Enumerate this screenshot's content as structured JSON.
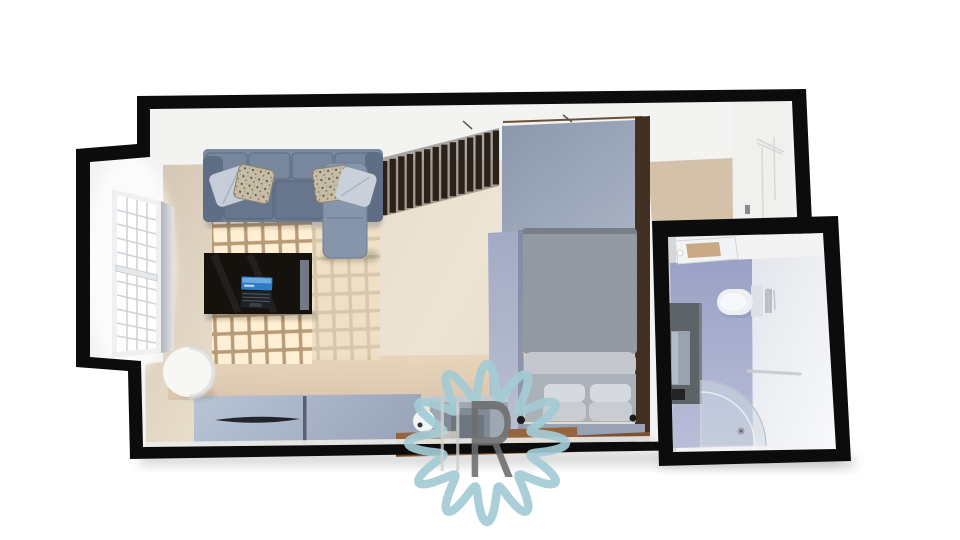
{
  "meta": {
    "title": "Studio apartment 3D floor plan render"
  },
  "watermark": {
    "letter_h": "H",
    "letter_r": "R",
    "flower_color": "#a3cbd5",
    "h_color": "#d3d0ca",
    "r_color": "#6d6d6d"
  },
  "palette": {
    "background": "#ffffff",
    "wall_black": "#0c0c0c",
    "wall_white": "#f3f3f2",
    "floor_beige": "#e8ddcb",
    "sunlight": "#ffefd4",
    "sofa_gray_blue": "#6d7c92",
    "chaise_gray": "#8695a9",
    "light_pillow": "#c6cdd8",
    "pattern_pillow": "#c7bda6",
    "slat_brown": "#2b2119",
    "wardrobe_panel": "#98a4ba",
    "bed_duvet": "#939aa3",
    "bed_pillow": "#d6d9de",
    "rug_lavender": "#a9b1c8",
    "wood_brown": "#96653f",
    "desk_black": "#15110d",
    "laptop_blue": "#2f7cc4",
    "sideboard_blue_gray": "#b2bdd1",
    "bath_floor_lavender": "#a6adcb",
    "vanity_gray": "#5d6367",
    "toilet_white": "#edeff3",
    "shower_glass": "#cfd9e3"
  },
  "scene": {
    "rooms": [
      "living-sleeping-area",
      "bathroom"
    ],
    "furniture": [
      "corner-sofa",
      "throw-pillows",
      "window-bay",
      "coffee-table",
      "laptop",
      "slatted-partition",
      "wardrobe-panel",
      "double-bed",
      "bed-pillows",
      "rug",
      "sideboard",
      "round-column",
      "desk-with-seat",
      "built-in-closet",
      "toilet",
      "vanity-with-mirror",
      "shower-enclosure",
      "towel-bar",
      "ceiling-light"
    ]
  }
}
